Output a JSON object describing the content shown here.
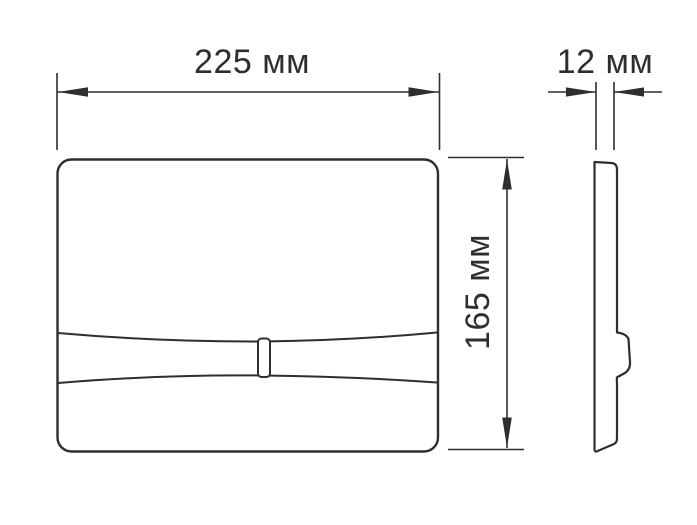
{
  "drawing": {
    "views": {
      "front": "front-view",
      "side": "side-view"
    },
    "dimensions": {
      "width": {
        "value": 225,
        "unit": "мм",
        "label": "225 мм"
      },
      "height": {
        "value": 165,
        "unit": "мм",
        "label": "165 мм"
      },
      "depth": {
        "value": 12,
        "unit": "мм",
        "label": "12 мм"
      }
    },
    "colors": {
      "line": "#2e2e2e",
      "background": "#ffffff"
    }
  }
}
